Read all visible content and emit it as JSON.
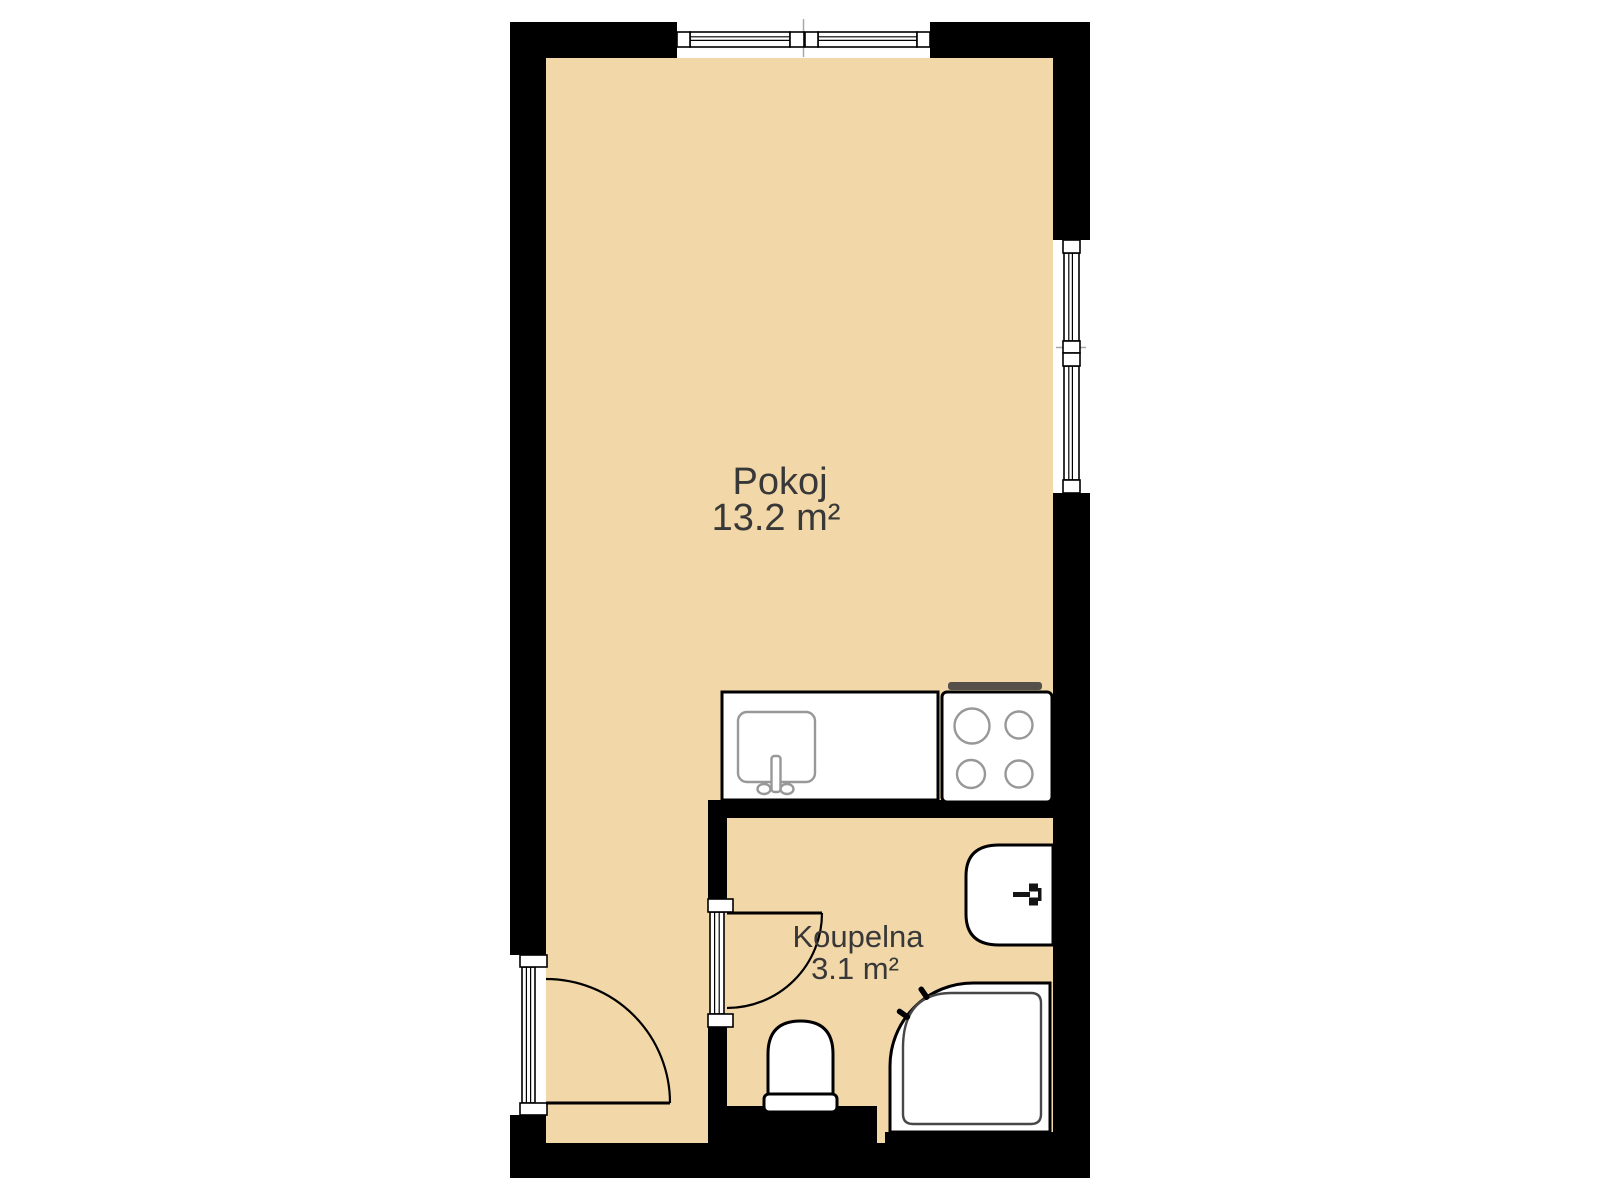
{
  "plan": {
    "colors": {
      "background": "#ffffff",
      "floor": "#f2d8a8",
      "wall": "#000000",
      "text": "#383838",
      "fixtureStroke": "#989898",
      "trayStroke": "#474747",
      "thinLine": "#a8a8a8",
      "stoveBar": "#55504a"
    },
    "rooms": [
      {
        "name": "Pokoj",
        "area": "13.2 m²"
      },
      {
        "name": "Koupelna",
        "area": "3.1 m²"
      }
    ],
    "fixtures": {
      "kitchen_counter": "kitchen-counter-with-sink",
      "stove": "four-burner-stove",
      "bathroom_sink": "washbasin",
      "toilet": "toilet",
      "shower": "corner-shower"
    },
    "openings": {
      "top_window": "window",
      "right_window": "window",
      "entrance_door": "entrance-door",
      "bathroom_door": "bathroom-door"
    }
  }
}
